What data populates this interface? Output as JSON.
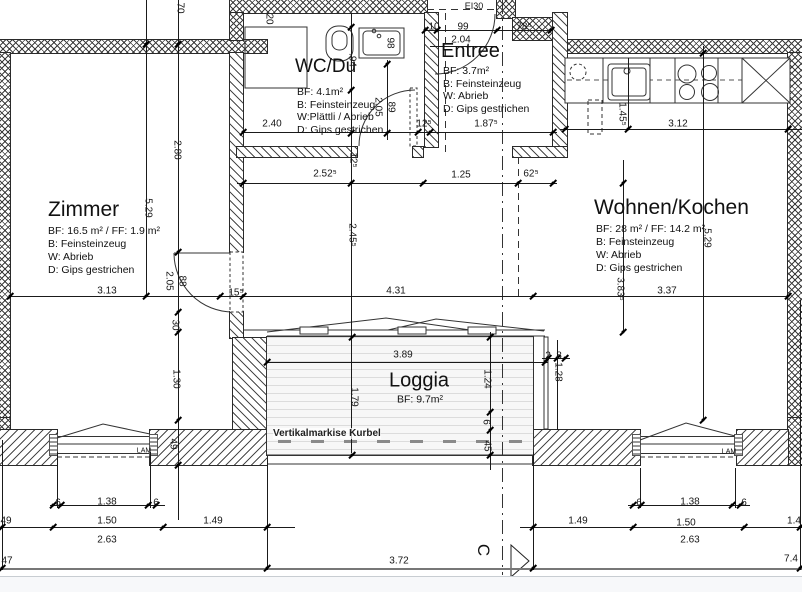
{
  "drawing": {
    "rooms": {
      "zimmer": {
        "title": "Zimmer",
        "line1": "BF: 16.5 m² / FF: 1.9 m²",
        "line2": "B: Feinsteinzeug",
        "line3": "W: Abrieb",
        "line4": "D: Gips gestrichen"
      },
      "wc": {
        "title": "WC/Du",
        "line1": "BF: 4.1m²",
        "line2": "B: Feinsteinzeug",
        "line3": "W:Plättli / Abrieb",
        "line4": "D: Gips gestrichen"
      },
      "entree": {
        "title": "Entree",
        "line1": "BF: 3.7m²",
        "line2": "B: Feinsteinzeug",
        "line3": "W: Abrieb",
        "line4": "D: Gips gestrichen"
      },
      "wohnen": {
        "title": "Wohnen/Kochen",
        "line1": "BF: 28 m² / FF: 14.2 m²",
        "line2": "B: Feinsteinzeug",
        "line3": "W: Abrieb",
        "line4": "D: Gips gestrichen"
      },
      "loggia": {
        "title": "Loggia",
        "line1": "BF: 9.7m²"
      }
    },
    "annotations": {
      "markise": "Vertikalmarkise Kurbel",
      "fire_rating": "EI30",
      "lam_left": "LAM",
      "lam_right": "LAM",
      "section_letter": "C"
    },
    "dimensions": [
      {
        "text": "10",
        "x": 434,
        "y": 27
      },
      {
        "text": "99",
        "x": 463,
        "y": 27
      },
      {
        "text": "78⁵",
        "x": 524,
        "y": 27
      },
      {
        "text": "2.04",
        "x": 461,
        "y": 40
      },
      {
        "text": "3.12",
        "x": 678,
        "y": 124
      },
      {
        "text": "2.40",
        "x": 272,
        "y": 124
      },
      {
        "text": "12⁵",
        "x": 424,
        "y": 124
      },
      {
        "text": "1.87⁵",
        "x": 486,
        "y": 124
      },
      {
        "text": "2.52⁵",
        "x": 325,
        "y": 174
      },
      {
        "text": "1.25",
        "x": 461,
        "y": 175
      },
      {
        "text": "62⁵",
        "x": 531,
        "y": 174
      },
      {
        "text": "3.13",
        "x": 107,
        "y": 291
      },
      {
        "text": "15⁵",
        "x": 236,
        "y": 293
      },
      {
        "text": "4.31",
        "x": 396,
        "y": 291
      },
      {
        "text": "3.37",
        "x": 667,
        "y": 291
      },
      {
        "text": "3.89",
        "x": 403,
        "y": 355
      },
      {
        "text": "2",
        "x": 548,
        "y": 356
      },
      {
        "text": "8",
        "x": 559,
        "y": 356
      },
      {
        "text": "6",
        "x": 58,
        "y": 503
      },
      {
        "text": "1.38",
        "x": 107,
        "y": 502
      },
      {
        "text": "6",
        "x": 156,
        "y": 503
      },
      {
        "text": "6",
        "x": 639,
        "y": 503
      },
      {
        "text": "1.38",
        "x": 690,
        "y": 502
      },
      {
        "text": "6",
        "x": 744,
        "y": 503
      },
      {
        "text": "49",
        "x": 6,
        "y": 521
      },
      {
        "text": "1.50",
        "x": 107,
        "y": 521
      },
      {
        "text": "1.49",
        "x": 213,
        "y": 521
      },
      {
        "text": "1.49",
        "x": 578,
        "y": 521
      },
      {
        "text": "1.50",
        "x": 686,
        "y": 523
      },
      {
        "text": "1.4",
        "x": 794,
        "y": 521
      },
      {
        "text": "2.63",
        "x": 107,
        "y": 540
      },
      {
        "text": "2.63",
        "x": 690,
        "y": 540
      },
      {
        "text": "47",
        "x": 7,
        "y": 561
      },
      {
        "text": "3.72",
        "x": 399,
        "y": 561
      },
      {
        "text": "7.4",
        "x": 791,
        "y": 559
      },
      {
        "text": "70",
        "x": 180,
        "y": 8,
        "rot": true
      },
      {
        "text": "20",
        "x": 269,
        "y": 19,
        "rot": true
      },
      {
        "text": "98",
        "x": 390,
        "y": 43,
        "rot": true
      },
      {
        "text": ".94",
        "x": 352,
        "y": 60,
        "rot": true
      },
      {
        "text": "2.05",
        "x": 378,
        "y": 107,
        "rot": true
      },
      {
        "text": "89",
        "x": 391,
        "y": 107,
        "rot": true
      },
      {
        "text": "12⁵",
        "x": 353,
        "y": 160,
        "rot": true
      },
      {
        "text": "1.45⁵",
        "x": 622,
        "y": 114,
        "rot": true
      },
      {
        "text": "2.80",
        "x": 177,
        "y": 150,
        "rot": true
      },
      {
        "text": "5.29",
        "x": 148,
        "y": 208,
        "rot": true
      },
      {
        "text": "2.45⁵",
        "x": 352,
        "y": 235,
        "rot": true
      },
      {
        "text": "2.05",
        "x": 169,
        "y": 281,
        "rot": true
      },
      {
        "text": "88",
        "x": 182,
        "y": 281,
        "rot": true
      },
      {
        "text": "30",
        "x": 175,
        "y": 325,
        "rot": true
      },
      {
        "text": "1.30",
        "x": 176,
        "y": 379,
        "rot": true
      },
      {
        "text": "49",
        "x": 173,
        "y": 444,
        "rot": true
      },
      {
        "text": "5.29",
        "x": 707,
        "y": 238,
        "rot": true
      },
      {
        "text": "3.83⁵",
        "x": 620,
        "y": 289,
        "rot": true
      },
      {
        "text": "1.79",
        "x": 354,
        "y": 397,
        "rot": true
      },
      {
        "text": "1.24",
        "x": 487,
        "y": 379,
        "rot": true
      },
      {
        "text": "6",
        "x": 486,
        "y": 422,
        "rot": true
      },
      {
        "text": "45",
        "x": 487,
        "y": 446,
        "rot": true
      },
      {
        "text": "1.28",
        "x": 558,
        "y": 372,
        "rot": true
      }
    ]
  }
}
